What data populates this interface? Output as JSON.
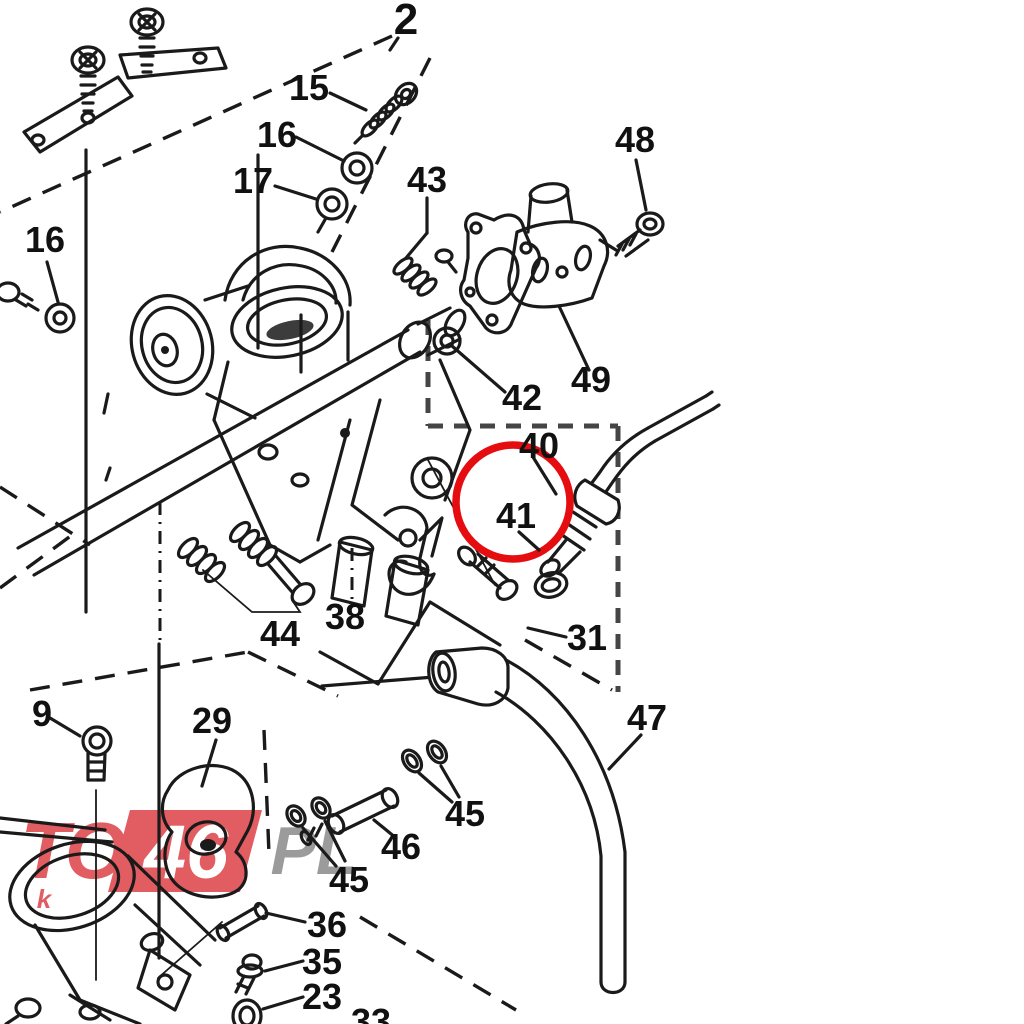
{
  "diagram": {
    "kind": "exploded-parts-diagram",
    "subject": "carburetor-throttle-body-assembly",
    "background_color": "#ffffff",
    "line_color": "#1a1a1a",
    "highlight": {
      "shape": "circle",
      "color": "#e60d10",
      "highlighted_part_number": "41"
    },
    "labels": [
      {
        "text": "2"
      },
      {
        "text": "15"
      },
      {
        "text": "16"
      },
      {
        "text": "17"
      },
      {
        "text": "43"
      },
      {
        "text": "48"
      },
      {
        "text": "16"
      },
      {
        "text": "49"
      },
      {
        "text": "42"
      },
      {
        "text": "40"
      },
      {
        "text": "41"
      },
      {
        "text": "31"
      },
      {
        "text": "38"
      },
      {
        "text": "44"
      },
      {
        "text": "9"
      },
      {
        "text": "29"
      },
      {
        "text": "47"
      },
      {
        "text": "45"
      },
      {
        "text": "46"
      },
      {
        "text": "45"
      },
      {
        "text": "36"
      },
      {
        "text": "35"
      },
      {
        "text": "23"
      },
      {
        "text": "33"
      }
    ],
    "watermark": {
      "left_text": "TO",
      "band_text": "46",
      "suffix_text": "PL",
      "small_text": "k",
      "red_color": "#e15d62",
      "gray_color": "#9b9b9b",
      "band_text_color": "#ffffff"
    }
  }
}
